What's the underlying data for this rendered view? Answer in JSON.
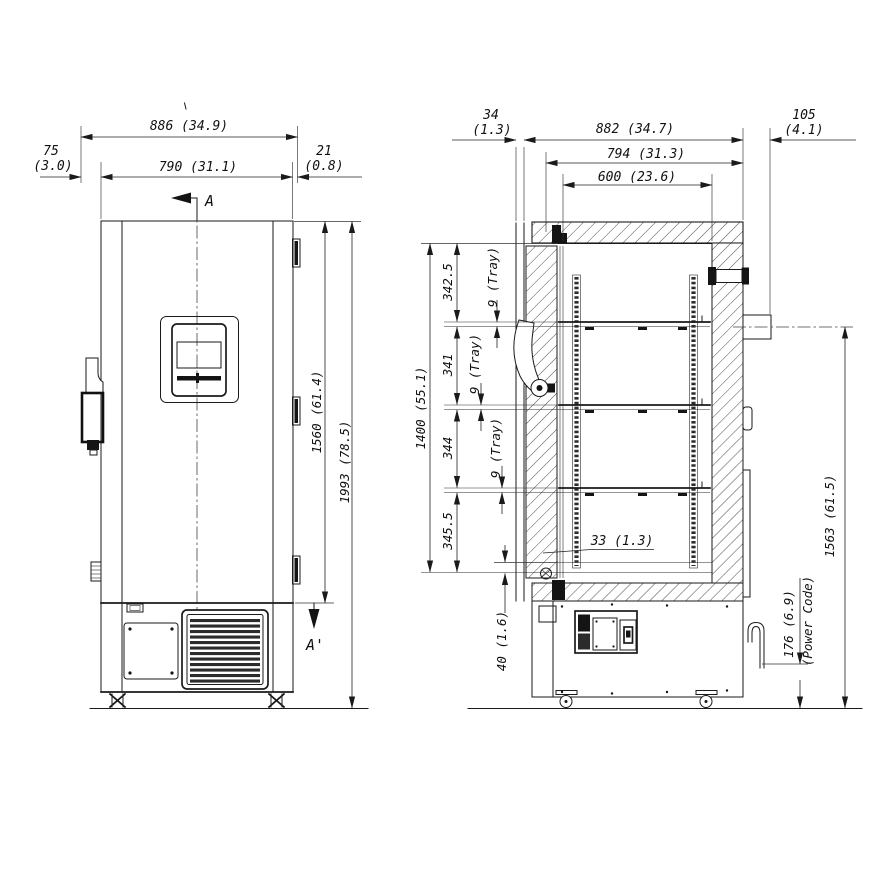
{
  "front_view": {
    "marker_a": "A",
    "marker_a_prime": "A'",
    "dims": {
      "width_total": "886 (34.9)",
      "width_body": "790 (31.1)",
      "handle_l1": "75",
      "handle_l2": "(3.0)",
      "hinge_l1": "21",
      "hinge_l2": "(0.8)",
      "height_door": "1560 (61.4)",
      "height_total": "1993 (78.5)"
    }
  },
  "side_view": {
    "dims": {
      "door_front_l1": "34",
      "door_front_l2": "(1.3)",
      "depth_body": "882 (34.7)",
      "depth_inner": "794 (31.3)",
      "depth_chamber": "600 (23.6)",
      "rear_l1": "105",
      "rear_l2": "(4.1)",
      "interior_height": "1400 (55.1)",
      "seg_1": "342.5",
      "seg_2": "341",
      "seg_3": "344",
      "seg_4": "345.5",
      "tray_1": "9 (Tray)",
      "tray_2": "9 (Tray)",
      "tray_3": "9 (Tray)",
      "door_edge": "33 (1.3)",
      "bottom_gap": "40 (1.6)",
      "port_height": "1563 (61.5)",
      "cord_height": "176 (6.9)",
      "cord_label": "(Power Code)"
    }
  }
}
